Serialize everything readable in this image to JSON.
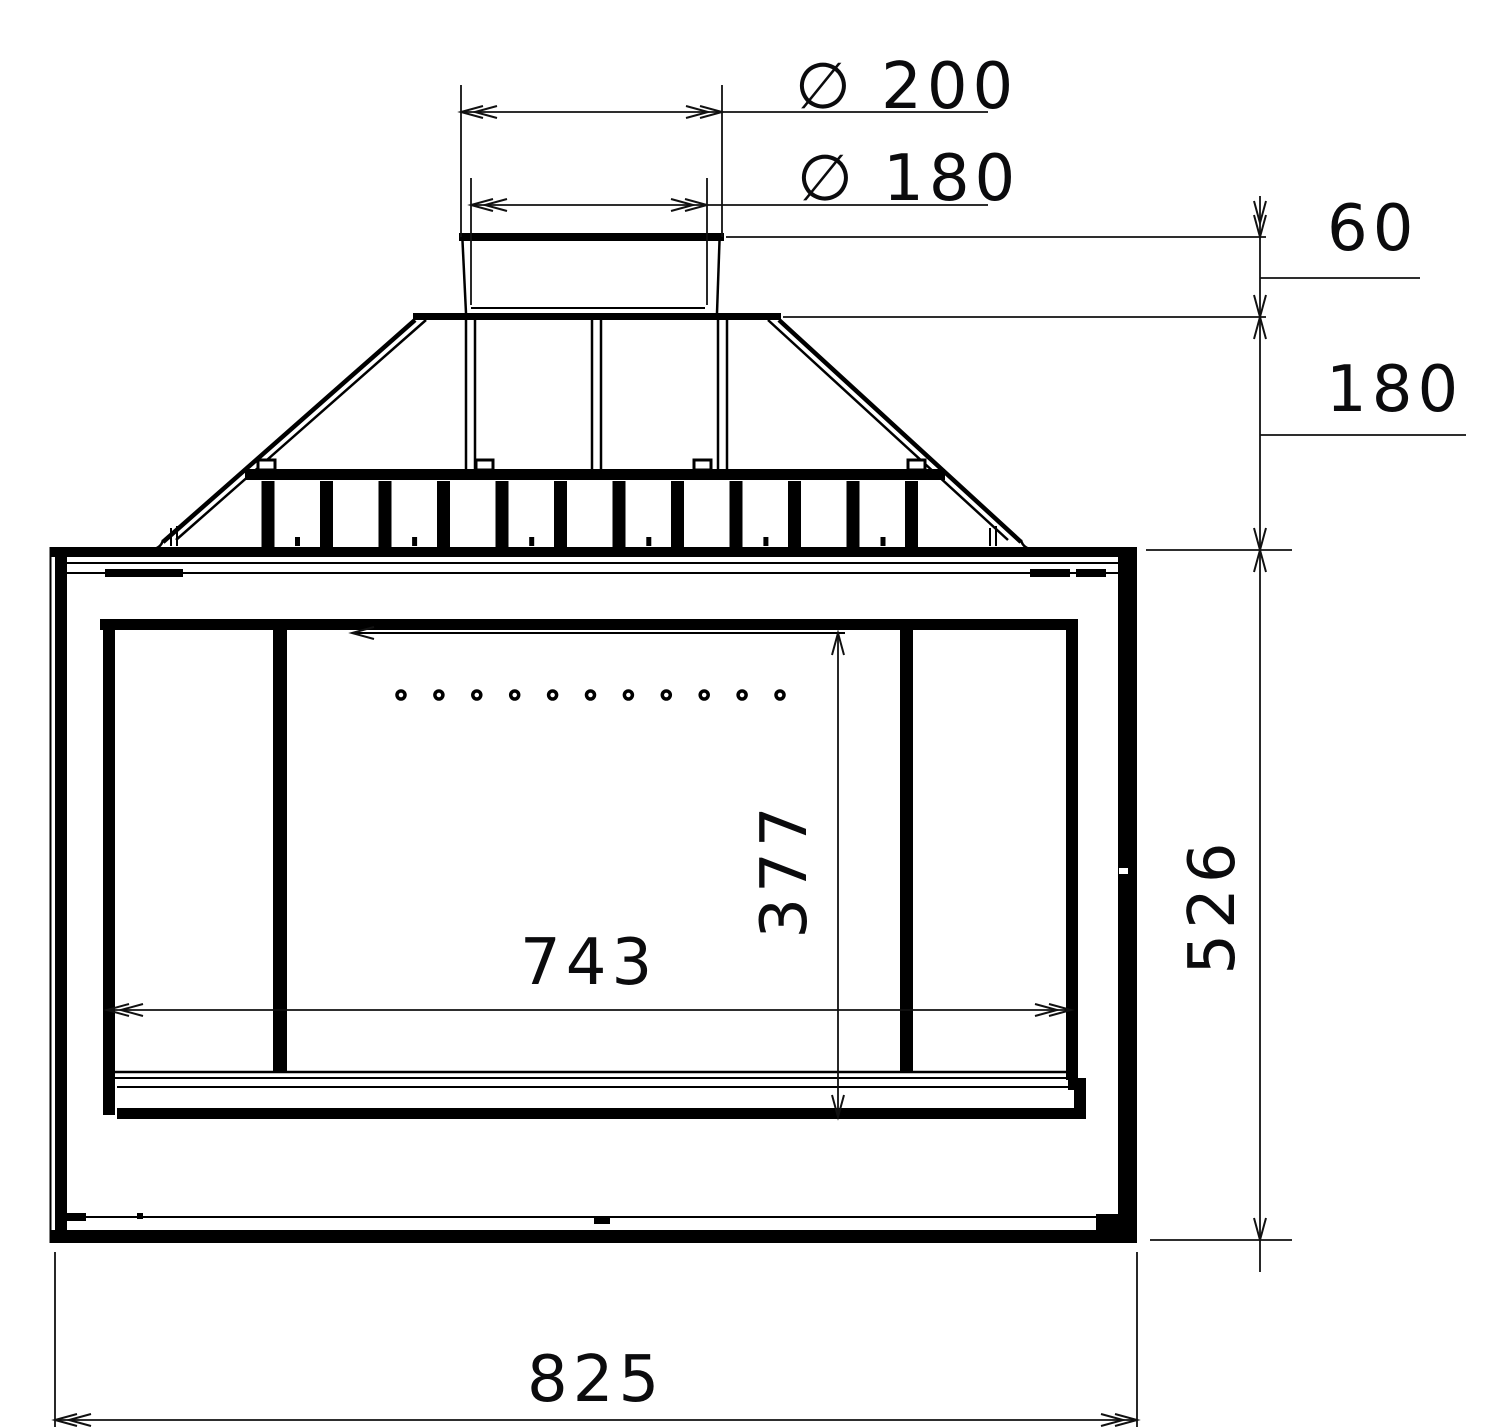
{
  "drawing": {
    "type": "technical-drawing",
    "view": "fireplace-insert-front-elevation",
    "dimensions": {
      "flue_outer_diameter": {
        "label": "∅ 200",
        "value": 200
      },
      "flue_inner_diameter": {
        "label": "∅ 180",
        "value": 180
      },
      "collar_height": {
        "label": "60",
        "value": 60
      },
      "hood_height": {
        "label": "180",
        "value": 180
      },
      "body_height": {
        "label": "526",
        "value": 526
      },
      "glass_height": {
        "label": "377",
        "value": 377
      },
      "glass_width": {
        "label": "743",
        "value": 743
      },
      "body_width": {
        "label": "825",
        "value": 825
      }
    },
    "features": {
      "rib_count": 12,
      "air_hole_count": 11
    }
  }
}
